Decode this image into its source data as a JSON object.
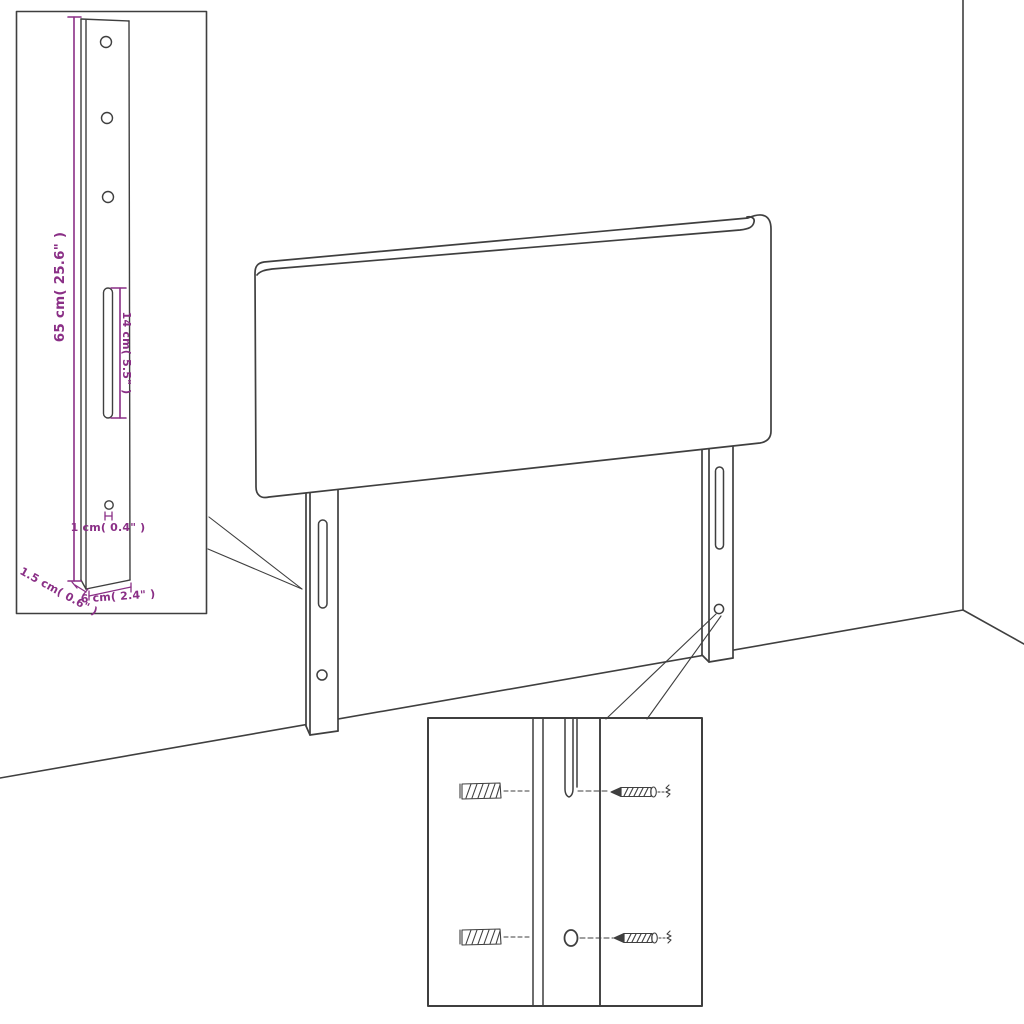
{
  "diagram": {
    "title": "Upholstered headboard with two mounting legs - assembly and dimension diagram",
    "colors": {
      "line": "#3f3f3f",
      "dimension": "#8a2f86",
      "background": "#ffffff"
    },
    "bracket_detail": {
      "dim_total_height": "65 cm( 25.6\" )",
      "dim_slot_length": "14 cm( 5.5\" )",
      "dim_hole": "1 cm( 0.4\" )",
      "dim_side_depth": "1.5 cm( 0.6\" )",
      "dim_width": "6 cm( 2.4\" )"
    },
    "hardware_detail": {
      "parts": [
        "wall-plug",
        "screw",
        "mounting-slot",
        "screw-hole"
      ]
    },
    "scene_parts": [
      "headboard-panel",
      "left-mounting-leg",
      "right-mounting-leg",
      "wall-corner",
      "floor-line"
    ]
  }
}
